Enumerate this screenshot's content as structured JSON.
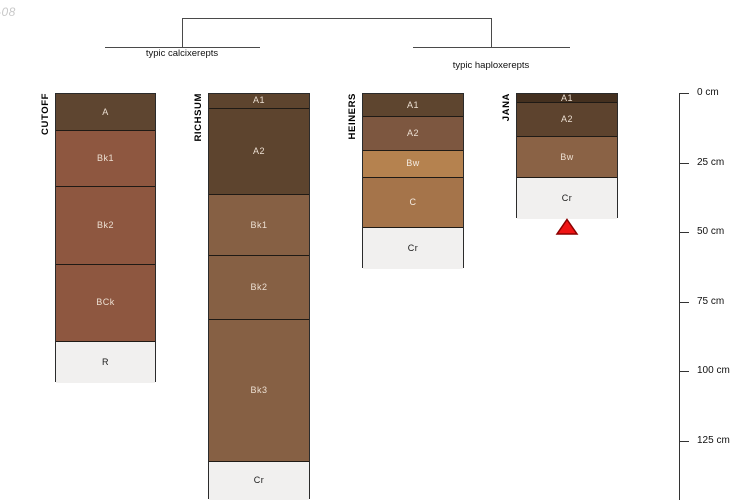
{
  "watermark": "-08",
  "classification": {
    "groups": [
      {
        "label": "typic calcixerepts",
        "profiles": [
          "CUTOFF",
          "RICHSUM"
        ]
      },
      {
        "label": "typic haploxerepts",
        "profiles": [
          "HEINERS",
          "JANA"
        ]
      }
    ]
  },
  "depth_scale": {
    "unit": "cm",
    "ticks": [
      {
        "label": "0 cm",
        "value_cm": 0
      },
      {
        "label": "25 cm",
        "value_cm": 25
      },
      {
        "label": "50 cm",
        "value_cm": 50
      },
      {
        "label": "75 cm",
        "value_cm": 75
      },
      {
        "label": "100 cm",
        "value_cm": 100
      },
      {
        "label": "125 cm",
        "value_cm": 125
      }
    ]
  },
  "profiles": [
    {
      "name": "CUTOFF",
      "left_px": 55,
      "width_px": 101,
      "horizons": [
        {
          "label": "A",
          "top_cm": 0,
          "bottom_cm": 13,
          "color": "#5e4530",
          "label_color": "#ecdfd2"
        },
        {
          "label": "Bk1",
          "top_cm": 13,
          "bottom_cm": 33,
          "color": "#8e5740",
          "label_color": "#ecdfd2"
        },
        {
          "label": "Bk2",
          "top_cm": 33,
          "bottom_cm": 61,
          "color": "#8e5740",
          "label_color": "#ecdfd2"
        },
        {
          "label": "BCk",
          "top_cm": 61,
          "bottom_cm": 89,
          "color": "#8e5740",
          "label_color": "#ecdfd2"
        },
        {
          "label": "R",
          "top_cm": 89,
          "bottom_cm": 104,
          "color": "#f1f0ef",
          "label_color": "#1a1a1a"
        }
      ]
    },
    {
      "name": "RICHSUM",
      "left_px": 208,
      "width_px": 102,
      "horizons": [
        {
          "label": "A1",
          "top_cm": 0,
          "bottom_cm": 5,
          "color": "#5d442e",
          "label_color": "#ecdfd2"
        },
        {
          "label": "A2",
          "top_cm": 5,
          "bottom_cm": 36,
          "color": "#5d442e",
          "label_color": "#ecdfd2"
        },
        {
          "label": "Bk1",
          "top_cm": 36,
          "bottom_cm": 58,
          "color": "#866044",
          "label_color": "#ecdfd2"
        },
        {
          "label": "Bk2",
          "top_cm": 58,
          "bottom_cm": 81,
          "color": "#866044",
          "label_color": "#ecdfd2"
        },
        {
          "label": "Bk3",
          "top_cm": 81,
          "bottom_cm": 132,
          "color": "#866044",
          "label_color": "#ecdfd2"
        },
        {
          "label": "Cr",
          "top_cm": 132,
          "bottom_cm": 146,
          "color": "#f1f0ef",
          "label_color": "#1a1a1a"
        }
      ]
    },
    {
      "name": "HEINERS",
      "left_px": 362,
      "width_px": 102,
      "horizons": [
        {
          "label": "A1",
          "top_cm": 0,
          "bottom_cm": 8,
          "color": "#5e452f",
          "label_color": "#ecdfd2"
        },
        {
          "label": "A2",
          "top_cm": 8,
          "bottom_cm": 20,
          "color": "#7d5740",
          "label_color": "#ecdfd2"
        },
        {
          "label": "Bw",
          "top_cm": 20,
          "bottom_cm": 30,
          "color": "#b5824f",
          "label_color": "#f5ece2"
        },
        {
          "label": "C",
          "top_cm": 30,
          "bottom_cm": 48,
          "color": "#a5744a",
          "label_color": "#f5ece2"
        },
        {
          "label": "Cr",
          "top_cm": 48,
          "bottom_cm": 63,
          "color": "#f1f0ef",
          "label_color": "#1a1a1a"
        }
      ]
    },
    {
      "name": "JANA",
      "left_px": 516,
      "width_px": 102,
      "horizons": [
        {
          "label": "A1",
          "top_cm": 0,
          "bottom_cm": 3,
          "color": "#44301f",
          "label_color": "#ecdfd2"
        },
        {
          "label": "A2",
          "top_cm": 3,
          "bottom_cm": 15,
          "color": "#5d432e",
          "label_color": "#ecdfd2"
        },
        {
          "label": "Bw",
          "top_cm": 15,
          "bottom_cm": 30,
          "color": "#8a6245",
          "label_color": "#ecdfd2"
        },
        {
          "label": "Cr",
          "top_cm": 30,
          "bottom_cm": 45,
          "color": "#f1f0ef",
          "label_color": "#1a1a1a"
        }
      ],
      "marker": {
        "shape": "triangle",
        "fill": "#f01414",
        "stroke": "#8b0000"
      }
    }
  ]
}
